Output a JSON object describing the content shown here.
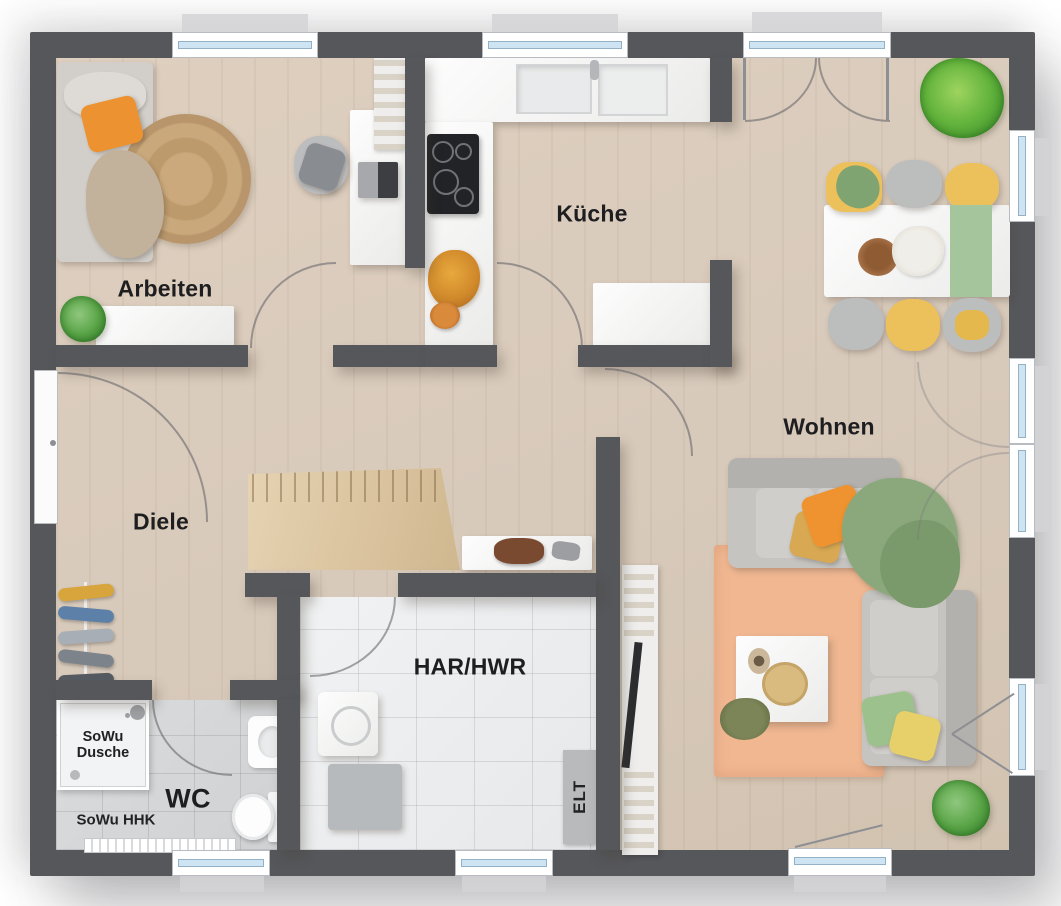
{
  "plan": {
    "rooms": {
      "arbeiten": "Arbeiten",
      "kueche": "Küche",
      "wohnen": "Wohnen",
      "diele": "Diele",
      "har_hwr": "HAR/HWR",
      "wc": "WC"
    },
    "annotations": {
      "sowu_dusche_line1": "SoWu",
      "sowu_dusche_line2": "Dusche",
      "sowu_hhk": "SoWu HHK",
      "elt": "ELT"
    },
    "colors": {
      "wall": "#56575b",
      "floor_wood": "#d9cdbe",
      "tile_wc": "#d5d7d8",
      "tile_har": "#eceeef",
      "window_glass": "#cfe4f2",
      "accent_orange": "#ee9330",
      "accent_yellow": "#ecc05a",
      "accent_green": "#8aa87b",
      "rug_living": "#f0b791",
      "rug_jute": "#c9a87c",
      "sofa_gray": "#c6c4c1"
    }
  }
}
